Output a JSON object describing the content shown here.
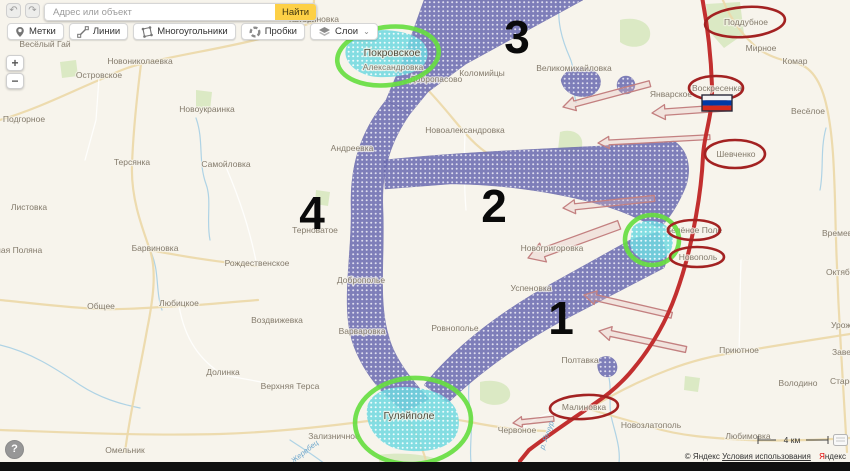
{
  "toolbar": {
    "search_placeholder": "Адрес или объект",
    "search_button": "Найти",
    "buttons": [
      {
        "label": "Метки",
        "icon": "pin-icon"
      },
      {
        "label": "Линии",
        "icon": "line-icon"
      },
      {
        "label": "Многоугольники",
        "icon": "polygon-icon"
      },
      {
        "label": "Пробки",
        "icon": "traffic-icon"
      },
      {
        "label": "Слои",
        "icon": "layers-icon"
      }
    ],
    "layers_chevron": "⌄"
  },
  "icons": {
    "undo": "↶",
    "redo": "↷"
  },
  "zoom_controls": {
    "zoom_in": "+",
    "zoom_out": "−"
  },
  "help_button": "?",
  "map": {
    "scale_label": "4 км",
    "attribution": {
      "copyright": "© Яндекс",
      "terms": "Условия использования",
      "brand_initial": "Я",
      "brand_rest": "ндекс"
    },
    "zone_numbers": [
      {
        "text": "3",
        "x": 517,
        "y": 53
      },
      {
        "text": "2",
        "x": 494,
        "y": 222
      },
      {
        "text": "1",
        "x": 561,
        "y": 334
      },
      {
        "text": "4",
        "x": 312,
        "y": 229
      }
    ],
    "green_circled": [
      "Покровское",
      "Темировка",
      "Гуляйполе"
    ],
    "red_circled": [
      "Поддубное",
      "Воскресенка",
      "Шевченко",
      "Зелёное Поле",
      "Новополь",
      "Малиновка"
    ],
    "flag": "russia-flag",
    "labels": [
      {
        "text": "Катериновка",
        "x": 314,
        "y": 22
      },
      {
        "text": "Ливадное",
        "x": 351,
        "y": 35
      },
      {
        "text": "Весёлый Гай",
        "x": 45,
        "y": 47
      },
      {
        "text": "Новониколаевка",
        "x": 140,
        "y": 64
      },
      {
        "text": "Островское",
        "x": 99,
        "y": 78
      },
      {
        "text": "Подгорное",
        "x": 24,
        "y": 122
      },
      {
        "text": "Новоукраинка",
        "x": 207,
        "y": 112
      },
      {
        "text": "Терсянка",
        "x": 132,
        "y": 165
      },
      {
        "text": "Самойловка",
        "x": 226,
        "y": 167
      },
      {
        "text": "Листовка",
        "x": 29,
        "y": 210
      },
      {
        "text": "Ясная Поляна",
        "x": 14,
        "y": 253
      },
      {
        "text": "Барвиновка",
        "x": 155,
        "y": 251
      },
      {
        "text": "Рождественское",
        "x": 257,
        "y": 266
      },
      {
        "text": "Общее",
        "x": 101,
        "y": 309
      },
      {
        "text": "Любицкое",
        "x": 179,
        "y": 306
      },
      {
        "text": "Воздвижевка",
        "x": 277,
        "y": 323
      },
      {
        "text": "Долинка",
        "x": 223,
        "y": 375
      },
      {
        "text": "Верхняя Терса",
        "x": 290,
        "y": 389
      },
      {
        "text": "Омельник",
        "x": 125,
        "y": 453
      },
      {
        "text": "Зализничное",
        "x": 334,
        "y": 439
      },
      {
        "text": "Покровское",
        "x": 392,
        "y": 56,
        "kind": "big"
      },
      {
        "text": "Александровка",
        "x": 393,
        "y": 70
      },
      {
        "text": "Добропасово",
        "x": 436,
        "y": 82
      },
      {
        "text": "Коломийцы",
        "x": 482,
        "y": 76
      },
      {
        "text": "Великомихайловка",
        "x": 574,
        "y": 71
      },
      {
        "text": "Новоалександровка",
        "x": 465,
        "y": 133
      },
      {
        "text": "Андреевка",
        "x": 352,
        "y": 151
      },
      {
        "text": "Терноватое",
        "x": 315,
        "y": 233
      },
      {
        "text": "Доброполье",
        "x": 361,
        "y": 283
      },
      {
        "text": "Варваровка",
        "x": 362,
        "y": 334
      },
      {
        "text": "Ровнополье",
        "x": 455,
        "y": 331
      },
      {
        "text": "Новогригоровка",
        "x": 552,
        "y": 251
      },
      {
        "text": "Успеновка",
        "x": 531,
        "y": 291
      },
      {
        "text": "Гуляйполе",
        "x": 409,
        "y": 419,
        "kind": "big"
      },
      {
        "text": "Червоное",
        "x": 517,
        "y": 433
      },
      {
        "text": "Январское",
        "x": 671,
        "y": 97
      },
      {
        "text": "Мирное",
        "x": 761,
        "y": 51
      },
      {
        "text": "Комар",
        "x": 795,
        "y": 64
      },
      {
        "text": "Весёлое",
        "x": 808,
        "y": 114
      },
      {
        "text": "Поддубное",
        "x": 746,
        "y": 25
      },
      {
        "text": "Воскресенка",
        "x": 717,
        "y": 91
      },
      {
        "text": "Шевченко",
        "x": 736,
        "y": 157
      },
      {
        "text": "Зелёное Поле",
        "x": 694,
        "y": 233
      },
      {
        "text": "Новополь",
        "x": 698,
        "y": 260
      },
      {
        "text": "Малиновка",
        "x": 584,
        "y": 410
      },
      {
        "text": "Полтавка",
        "x": 580,
        "y": 363
      },
      {
        "text": "Приютное",
        "x": 739,
        "y": 353
      },
      {
        "text": "Володино",
        "x": 798,
        "y": 386
      },
      {
        "text": "Новозлатополь",
        "x": 651,
        "y": 428
      },
      {
        "text": "Любимовка",
        "x": 748,
        "y": 439
      },
      {
        "text": "Времевка",
        "x": 822,
        "y": 236,
        "anchor": "start"
      },
      {
        "text": "Октябрьское",
        "x": 826,
        "y": 275,
        "anchor": "start"
      },
      {
        "text": "Урожайное",
        "x": 831,
        "y": 328,
        "anchor": "start"
      },
      {
        "text": "Заветное",
        "x": 832,
        "y": 355,
        "anchor": "start"
      },
      {
        "text": "Старомлиновка",
        "x": 830,
        "y": 384,
        "anchor": "start"
      },
      {
        "text": "р. Жеребец",
        "x": 303,
        "y": 456,
        "kind": "water",
        "rotate": -38
      },
      {
        "text": "р. Янчур",
        "x": 549,
        "y": 436,
        "kind": "water",
        "rotate": -70
      }
    ]
  },
  "colors": {
    "front_line": "#c22f2f",
    "advance_hatch": "#6e6eb2",
    "captured_hatch": "#6fd9e0",
    "green_circle": "#67dd41",
    "red_circle": "#a32222",
    "flag_white": "#f4f4f4",
    "flag_blue": "#0039a6",
    "flag_red": "#d52b1e",
    "search_accent": "#fdd046"
  }
}
